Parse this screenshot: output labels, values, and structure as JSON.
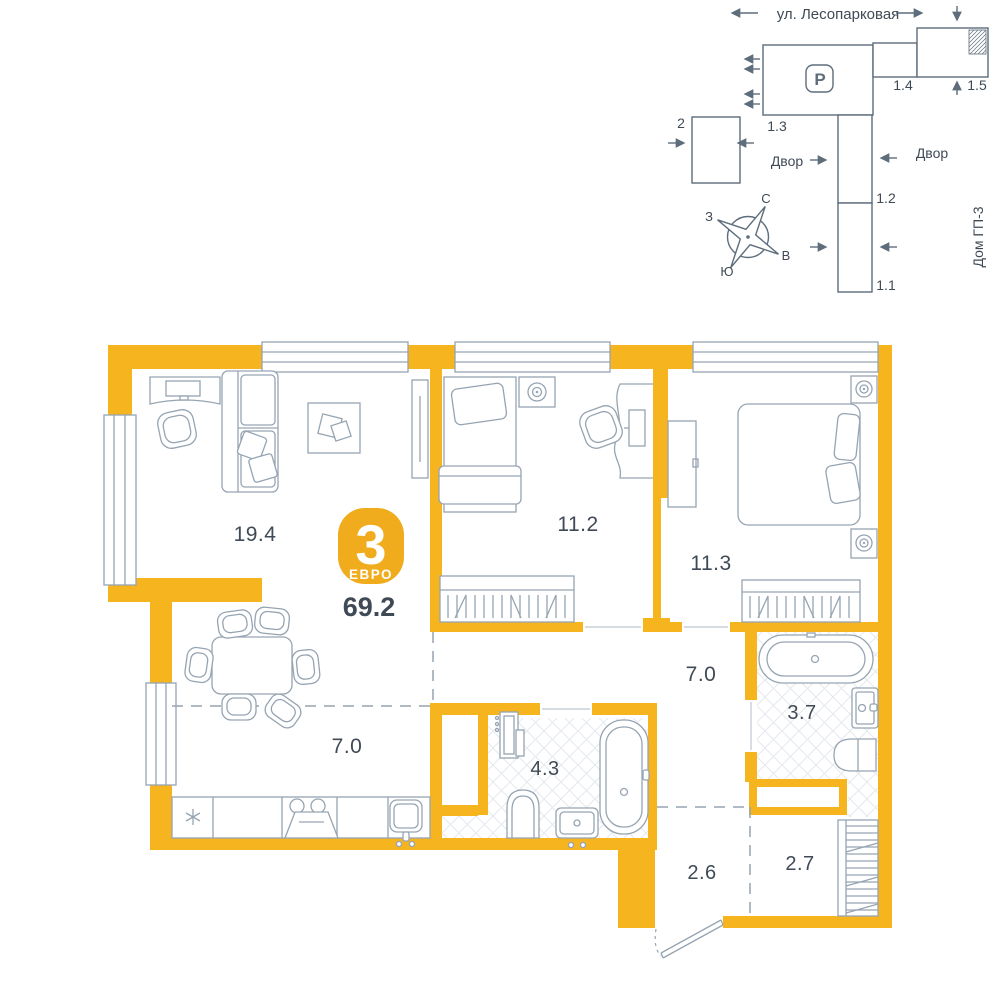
{
  "site_plan": {
    "street_name": "ул. Лесопарковая",
    "parking_label": "P",
    "yard_left": "Двор",
    "yard_right": "Двор",
    "house_gp3": "Дом ГП-3",
    "building_labels": {
      "b2": "2",
      "b13": "1.3",
      "b14": "1.4",
      "b15": "1.5",
      "b12": "1.2",
      "b11": "1.1"
    },
    "compass": {
      "n": "С",
      "s": "Ю",
      "w": "З",
      "e": "В"
    }
  },
  "plan": {
    "badge": {
      "rooms_count": "3",
      "type_label": "ЕВРО",
      "total_area": "69.2"
    },
    "areas": {
      "living": "19.4",
      "bedroom1": "11.2",
      "bedroom2": "11.3",
      "corridor": "7.0",
      "bath_small": "3.7",
      "bath_large": "4.3",
      "kitchen": "7.0",
      "hall": "2.6",
      "wardrobe": "2.7"
    },
    "colors": {
      "wall": "#F6B41E",
      "badge": "#F0AC1C",
      "text": "#3F4A56",
      "furniture": "#96A4B2",
      "site_lines": "#5D6D7C"
    }
  }
}
